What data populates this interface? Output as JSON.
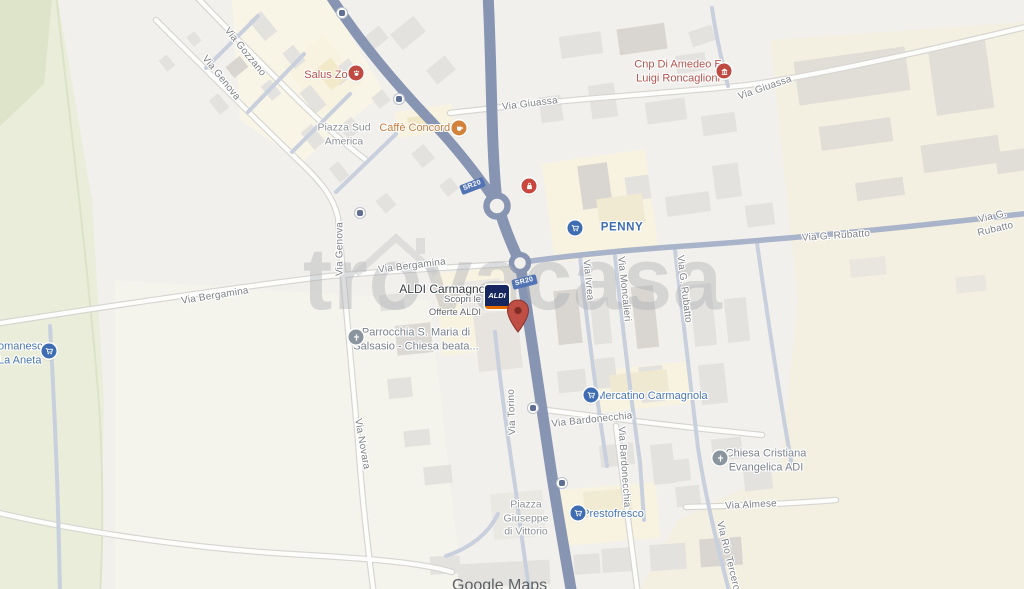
{
  "watermark": {
    "text": "trovacasa"
  },
  "attribution": {
    "text": "Google Maps"
  },
  "shields": {
    "sr20": "SR20"
  },
  "streets": {
    "gozzano": "Via Gozzano",
    "genova": "Via Genova",
    "giuassa": "Via Giuassa",
    "rubatto": "Via G. Rubatto",
    "bergamina": "Via Bergamina",
    "ivrea": "Via Ivrea",
    "moncalieri": "Via Moncalieri",
    "novara": "Via Novara",
    "torino": "Via Torino",
    "bardonecchia": "Via Bardonecchia",
    "almese": "Via Almese",
    "rio_tercero": "Via Rio Tercero"
  },
  "pois": {
    "salus_zoo": {
      "label": "Salus Zoo"
    },
    "piazza_sud_america": {
      "label": "Piazza Sud\nAmerica"
    },
    "caffe_concordia": {
      "label": "Caffè Concordia"
    },
    "cnp": {
      "label": "Cnp Di Amedeo E\nLuigi Roncaglioni"
    },
    "penny": {
      "label": "PENNY"
    },
    "aldi": {
      "label": "ALDI Carmagnola",
      "ad": "Scopri le\nOfferte ALDI",
      "logo": "ALDI"
    },
    "parrocchia": {
      "label": "Parrocchia S. Maria di\nSalsasio - Chiesa beata..."
    },
    "mercatino": {
      "label": "Mercatino Carmagnola"
    },
    "chiesa_evangelica": {
      "label": "Chiesa Cristiana\nEvangelica ADI"
    },
    "prestofresco": {
      "label": "Prestofresco"
    },
    "la_aneta": {
      "label": "omanesc,\nLa Aneta"
    },
    "piazza_giuseppe": {
      "label": "Piazza\nGiuseppe\ndi Vittorio"
    }
  },
  "colors": {
    "road_major": "#8795b2",
    "poi_red": "#b5534b",
    "poi_orange": "#c77a3a",
    "poi_blue": "#4b76b1",
    "poi_gray": "#7a828c",
    "green_area": "#e9edda",
    "beige_area": "#f3efe1",
    "pin": "#bf4e44"
  }
}
